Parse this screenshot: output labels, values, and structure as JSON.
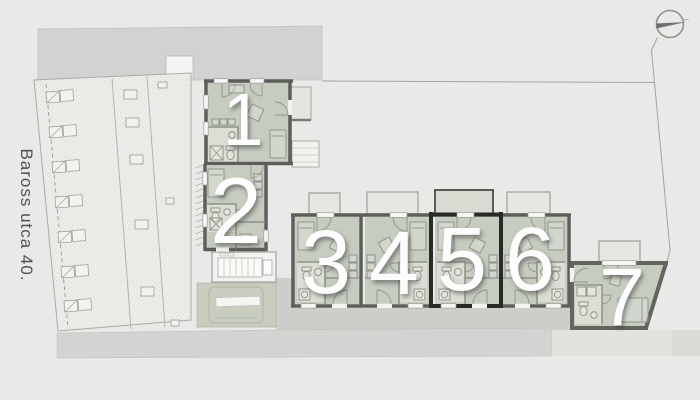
{
  "plan": {
    "street_label": "Baross utca 40.",
    "units": [
      {
        "id": "unit-1",
        "label": "1"
      },
      {
        "id": "unit-2",
        "label": "2"
      },
      {
        "id": "unit-3",
        "label": "3"
      },
      {
        "id": "unit-4",
        "label": "4"
      },
      {
        "id": "unit-5",
        "label": "5"
      },
      {
        "id": "unit-6",
        "label": "6"
      },
      {
        "id": "unit-7",
        "label": "7"
      }
    ],
    "highlighted_unit": "5"
  },
  "colors": {
    "background": "#e9e9e7",
    "street_band": "#d2d3d1",
    "room_fill": "#c6ccc0",
    "bath_fill": "#dbded4",
    "terrace_fill": "#e6e7e2",
    "wall": "#5d5d5a",
    "wall_highlight": "#292927",
    "walkway": "#cdceca",
    "pavement": "#d3d4d1",
    "number": "#fdfdfd"
  }
}
